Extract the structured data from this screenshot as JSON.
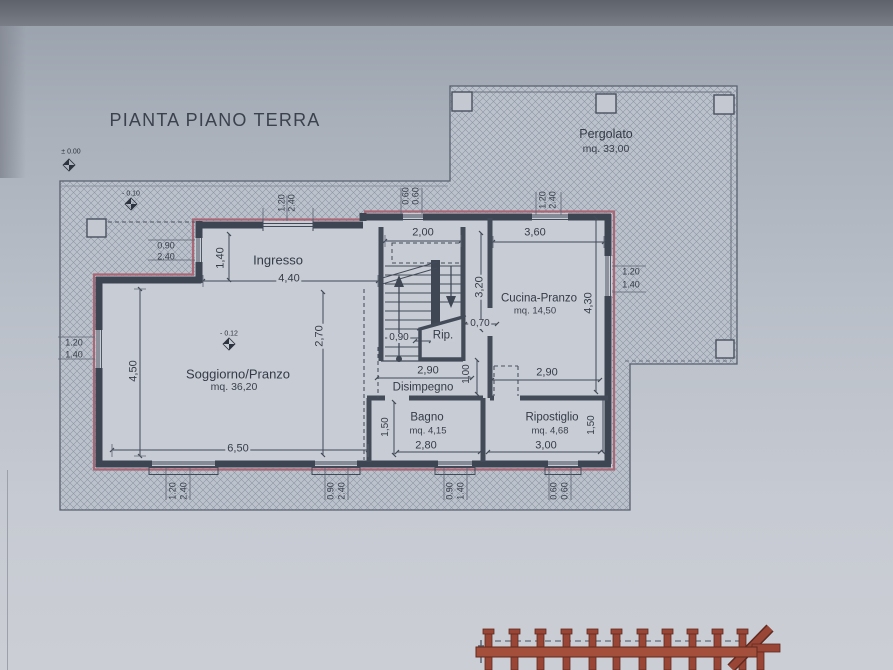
{
  "title": "PIANTA PIANO TERRA",
  "elevation_markers": {
    "ground": "± 0.00",
    "paving": "- 0.10",
    "interior": "- 0.12"
  },
  "pergolato": {
    "name": "Pergolato",
    "area": "mq. 33,00"
  },
  "rooms": {
    "ingresso": {
      "name": "Ingresso"
    },
    "soggiorno": {
      "name": "Soggiorno/Pranzo",
      "area": "mq. 36,20"
    },
    "cucina": {
      "name": "Cucina-Pranzo",
      "area": "mq. 14,50"
    },
    "rip": {
      "name": "Rip."
    },
    "disimpegno": {
      "name": "Disimpegno"
    },
    "bagno": {
      "name": "Bagno",
      "area": "mq. 4,15"
    },
    "ripostiglio": {
      "name": "Ripostiglio",
      "area": "mq. 4,68"
    }
  },
  "dimensions": {
    "ingresso_width": "4,40",
    "ingresso_depth": "1,40",
    "stairs_width": "2,00",
    "stairs_flight": "0,90",
    "cucina_width": "3,60",
    "cucina_depth_left": "3,20",
    "cucina_depth_right": "4,30",
    "cucina_bottom": "2,90",
    "soggiorno_opening": "2,70",
    "soggiorno_depth": "4,50",
    "soggiorno_width": "6,50",
    "disimpegno_width": "2,90",
    "passage": "1,00",
    "rip_door": "0,70",
    "bagno_depth": "1,50",
    "bagno_width": "2,80",
    "ripostiglio_width": "3,00",
    "ripostiglio_depth": "1,50"
  },
  "openings": {
    "left_ingresso": [
      "0.90",
      "2.40"
    ],
    "top_ingresso": [
      "1.20",
      "2.40"
    ],
    "top_stairs": [
      "0.60",
      "0.60"
    ],
    "top_cucina": [
      "1.20",
      "2.40"
    ],
    "right_cucina": [
      "1.20",
      "1.40"
    ],
    "left_soggiorno": [
      "1.20",
      "1.40"
    ],
    "bottom_soggiorno_a": [
      "1.20",
      "2.40"
    ],
    "bottom_soggiorno_b": [
      "0.90",
      "2.40"
    ],
    "bottom_bagno": [
      "0.90",
      "1.40"
    ],
    "bottom_ripostiglio": [
      "0.60",
      "0.60"
    ]
  },
  "colors": {
    "line": "#424a58",
    "red_outline": "#aa6270",
    "fence": "#9a4636"
  }
}
